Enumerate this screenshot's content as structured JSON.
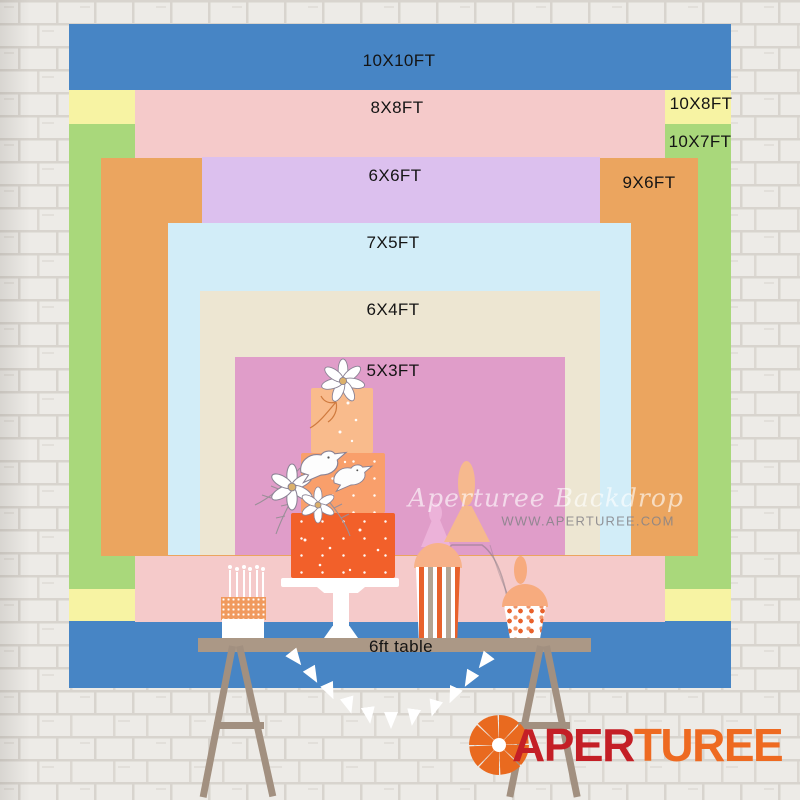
{
  "chart": {
    "description": "Backdrop size comparison chart, nested rectangles bottom-aligned on a 6ft table scene",
    "sizes": [
      {
        "id": "10x10",
        "label": "10X10FT",
        "color": "#4785c5"
      },
      {
        "id": "10x8",
        "label": "10X8FT",
        "color": "#f7f3a3"
      },
      {
        "id": "10x7",
        "label": "10X7FT",
        "color": "#a9d87b"
      },
      {
        "id": "8x8",
        "label": "8X8FT",
        "color": "#f5caca"
      },
      {
        "id": "9x6",
        "label": "9X6FT",
        "color": "#eba55f"
      },
      {
        "id": "6x6",
        "label": "6X6FT",
        "color": "#dcc0ee"
      },
      {
        "id": "7x5",
        "label": "7X5FT",
        "color": "#d2edf8"
      },
      {
        "id": "6x4",
        "label": "6X4FT",
        "color": "#ede6d2"
      },
      {
        "id": "5x3",
        "label": "5X3FT",
        "color": "#e09dc9"
      }
    ],
    "table_label": "6ft table"
  },
  "watermark": {
    "line1": "Aperturee Backdrop",
    "line2": "WWW.APERTUREE.COM"
  },
  "logo": {
    "text_red": "APER",
    "text_orange": "TUREE",
    "red": "#c41f26",
    "orange": "#ee6a21"
  }
}
